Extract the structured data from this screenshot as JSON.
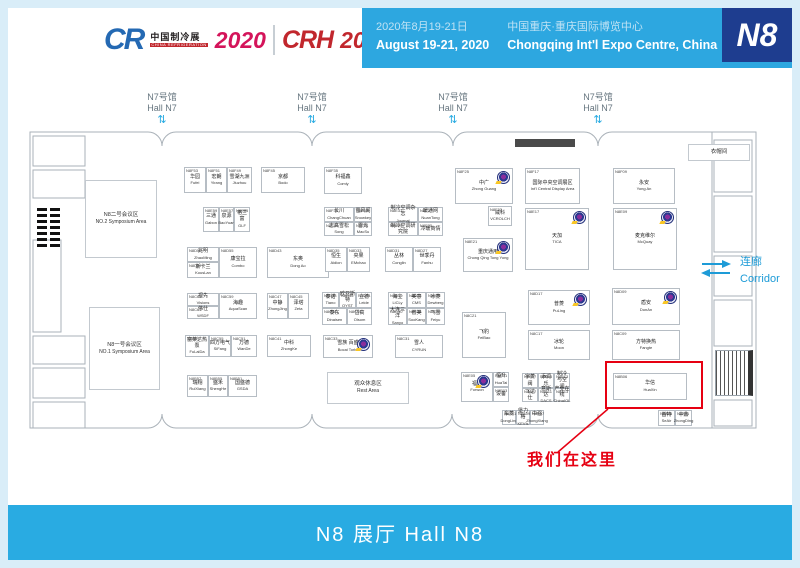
{
  "header": {
    "logo": {
      "cr": "CR",
      "cr_cn": "中国制冷展",
      "cr_en": "CHINA REFRIGERATION",
      "year1": "2020",
      "crh": "CRH",
      "year2": "2020",
      "tag_cn": "制冷·空调·暖通",
      "tag_en": "HVAC&R"
    },
    "dates_cn": "2020年8月19-21日",
    "dates_en": "August 19-21, 2020",
    "venue_cn": "中国重庆·重庆国际博览中心",
    "venue_en": "Chongqing Int'l Expo Centre, China",
    "badge": "N8"
  },
  "n7": {
    "cn": "N7号馆",
    "en": "Hall N7"
  },
  "icons": {
    "updown": "⇅"
  },
  "corridor": {
    "cn": "连廊",
    "en": "Corridor"
  },
  "marker_text": "我们在这里",
  "footer": {
    "label": "N8 展厅  Hall N8"
  },
  "colors": {
    "accent_blue": "#29abe2",
    "deep_blue": "#1e3d8f",
    "highlight_red": "#e60012"
  },
  "areas": {
    "sym2": {
      "cn": "N8二号会议区",
      "en": "NO.2 Symposium Area"
    },
    "sym1": {
      "cn": "N8一号会议区",
      "en": "NO.1 Symposium Area"
    },
    "rest": {
      "cn": "观众休息区",
      "en": "Rest Area"
    },
    "cloak": {
      "cn": "衣帽间",
      "en": "Cloakroom"
    }
  },
  "highlight": {
    "booth_id": "N8B06"
  },
  "booths": [
    {
      "id": "N8F53",
      "cn": "华园",
      "en": "Fufei",
      "x": 184,
      "y": 167,
      "w": 22,
      "h": 26
    },
    {
      "id": "N8F51",
      "cn": "宏朗",
      "en": "Yirang",
      "x": 206,
      "y": 167,
      "w": 21,
      "h": 26
    },
    {
      "id": "N8F49",
      "cn": "雪湖九洲",
      "en": "Jiuzhou",
      "x": 227,
      "y": 167,
      "w": 25,
      "h": 26
    },
    {
      "id": "N8F45",
      "cn": "京都",
      "en": "Bodo",
      "x": 261,
      "y": 167,
      "w": 44,
      "h": 26
    },
    {
      "id": "N8F35",
      "cn": "科福鑫",
      "en": "Comly",
      "x": 324,
      "y": 167,
      "w": 38,
      "h": 27
    },
    {
      "id": "N8F25",
      "cn": "中广",
      "en": "Zhong Guang",
      "x": 455,
      "y": 168,
      "w": 58,
      "h": 36,
      "logo": true
    },
    {
      "id": "N8F17",
      "cn": "国际中央空调展区",
      "en": "Int'l Central Display Area",
      "x": 525,
      "y": 168,
      "w": 55,
      "h": 36
    },
    {
      "id": "N8F09",
      "cn": "永安",
      "en": "Yong An",
      "x": 613,
      "y": 168,
      "w": 62,
      "h": 36
    },
    {
      "id": "N8E59",
      "cn": "三通",
      "en": "Gabon",
      "x": 203,
      "y": 207,
      "w": 16,
      "h": 25
    },
    {
      "id": "N8E57",
      "cn": "泉源",
      "en": "BaoYuan",
      "x": 219,
      "y": 207,
      "w": 15,
      "h": 25
    },
    {
      "id": "N8E55",
      "cn": "格兰富",
      "en": "GLF",
      "x": 234,
      "y": 207,
      "w": 16,
      "h": 25
    },
    {
      "id": "N8F30",
      "cn": "长川",
      "en": "ChangChuan",
      "x": 324,
      "y": 207,
      "w": 30,
      "h": 15
    },
    {
      "id": "N8F32",
      "cn": "雪风阁",
      "en": "Snowkey",
      "x": 354,
      "y": 207,
      "w": 18,
      "h": 15
    },
    {
      "id": "N8E30",
      "cn": "志高雪松",
      "en": "Song",
      "x": 324,
      "y": 222,
      "w": 30,
      "h": 14
    },
    {
      "id": "N8E34",
      "cn": "雪光",
      "en": "MacSu",
      "x": 354,
      "y": 222,
      "w": 18,
      "h": 14
    },
    {
      "id": "N8E31",
      "cn": "制冷空调杂志",
      "en": "Journal",
      "x": 388,
      "y": 207,
      "w": 30,
      "h": 15
    },
    {
      "id": "N8E27",
      "cn": "暖通网",
      "en": "NuanTong",
      "x": 418,
      "y": 207,
      "w": 25,
      "h": 15
    },
    {
      "id": "N8E29",
      "cn": "制冷空调研究院",
      "en": "",
      "x": 388,
      "y": 222,
      "w": 30,
      "h": 14
    },
    {
      "id": "N8E25",
      "cn": "冷暖商情",
      "en": "",
      "x": 418,
      "y": 222,
      "w": 25,
      "h": 14
    },
    {
      "id": "N8F23",
      "cn": "威科",
      "en": "VCROLCH",
      "x": 488,
      "y": 206,
      "w": 24,
      "h": 20
    },
    {
      "id": "N8E17",
      "cn": "天加",
      "en": "TICA",
      "x": 525,
      "y": 208,
      "w": 64,
      "h": 62,
      "logo": true
    },
    {
      "id": "N8E09",
      "cn": "麦克维尔",
      "en": "McQuay",
      "x": 613,
      "y": 208,
      "w": 64,
      "h": 62,
      "logo": true
    },
    {
      "id": "N8E21",
      "cn": "重庆通用",
      "en": "Chong Qing Tong Yong",
      "x": 463,
      "y": 238,
      "w": 50,
      "h": 34,
      "logo": true
    },
    {
      "id": "N8D59",
      "cn": "兆明",
      "en": "ZhaoMing",
      "x": 187,
      "y": 247,
      "w": 32,
      "h": 15
    },
    {
      "id": "N8D57",
      "cn": "斯卡兰",
      "en": "KousLan",
      "x": 187,
      "y": 262,
      "w": 32,
      "h": 16
    },
    {
      "id": "N8D55",
      "cn": "康宝拉",
      "en": "Combo",
      "x": 219,
      "y": 247,
      "w": 38,
      "h": 31
    },
    {
      "id": "N8D43",
      "cn": "东奥",
      "en": "Dong Ao",
      "x": 267,
      "y": 247,
      "w": 62,
      "h": 31
    },
    {
      "id": "N8D35",
      "cn": "恒生",
      "en": "Aidion",
      "x": 325,
      "y": 247,
      "w": 22,
      "h": 25
    },
    {
      "id": "N8D33",
      "cn": "央果",
      "en": "EMchao",
      "x": 347,
      "y": 247,
      "w": 23,
      "h": 25
    },
    {
      "id": "N8D31",
      "cn": "丛林",
      "en": "Conglin",
      "x": 385,
      "y": 247,
      "w": 28,
      "h": 25
    },
    {
      "id": "N8D27",
      "cn": "世季丹",
      "en": "Fanhu",
      "x": 413,
      "y": 247,
      "w": 28,
      "h": 25
    },
    {
      "id": "N8D17",
      "cn": "普菱",
      "en": "PuLing",
      "x": 528,
      "y": 290,
      "w": 62,
      "h": 35,
      "logo": true
    },
    {
      "id": "N8D09",
      "cn": "盾安",
      "en": "DunAn",
      "x": 612,
      "y": 288,
      "w": 68,
      "h": 37,
      "logo": true
    },
    {
      "id": "N8C63",
      "cn": "视先",
      "en": "Visions",
      "x": 187,
      "y": 293,
      "w": 32,
      "h": 13
    },
    {
      "id": "N8C61",
      "cn": "伟仕",
      "en": "WSDF",
      "x": 187,
      "y": 306,
      "w": 32,
      "h": 13
    },
    {
      "id": "N8C59",
      "cn": "海趣",
      "en": "AquaScan",
      "x": 219,
      "y": 293,
      "w": 38,
      "h": 26
    },
    {
      "id": "N8C47",
      "cn": "中静",
      "en": "ZhongJing",
      "x": 267,
      "y": 293,
      "w": 21,
      "h": 26
    },
    {
      "id": "N8C45",
      "cn": "泽塔",
      "en": "Zeta",
      "x": 288,
      "y": 293,
      "w": 21,
      "h": 26
    },
    {
      "id": "N8D38",
      "cn": "泰诺",
      "en": "Tiano",
      "x": 322,
      "y": 292,
      "w": 17,
      "h": 16
    },
    {
      "id": "N8D36",
      "cn": "欧亚斯特",
      "en": "OYST",
      "x": 339,
      "y": 292,
      "w": 17,
      "h": 16
    },
    {
      "id": "N8D34",
      "cn": "立德",
      "en": "Leide",
      "x": 356,
      "y": 292,
      "w": 16,
      "h": 16
    },
    {
      "id": "N8C38",
      "cn": "泰东",
      "en": "Dinaisen",
      "x": 322,
      "y": 308,
      "w": 25,
      "h": 17
    },
    {
      "id": "N8C34",
      "cn": "岱高",
      "en": "Olsom",
      "x": 347,
      "y": 308,
      "w": 25,
      "h": 17
    },
    {
      "id": "N8D30",
      "cn": "海立",
      "en": "LiCLy",
      "x": 388,
      "y": 292,
      "w": 19,
      "h": 16
    },
    {
      "id": "N8D28",
      "cn": "美意",
      "en": "CMS",
      "x": 407,
      "y": 292,
      "w": 19,
      "h": 16
    },
    {
      "id": "N8D26",
      "cn": "冰菱",
      "en": "Dewberg",
      "x": 426,
      "y": 292,
      "w": 19,
      "h": 16
    },
    {
      "id": "N8C30",
      "cn": "大连三洋",
      "en": "Sanyo",
      "x": 388,
      "y": 308,
      "w": 19,
      "h": 17
    },
    {
      "id": "N8C28",
      "cn": "普美",
      "en": "SooKang",
      "x": 407,
      "y": 308,
      "w": 19,
      "h": 17
    },
    {
      "id": "N8C26",
      "cn": "飞雪",
      "en": "Feiyu",
      "x": 426,
      "y": 308,
      "w": 19,
      "h": 17
    },
    {
      "id": "N8C21",
      "cn": "飞豹",
      "en": "FeiBao",
      "x": 462,
      "y": 312,
      "w": 44,
      "h": 46
    },
    {
      "id": "N8C57",
      "cn": "富莱达热泵",
      "en": "FuLaiDa",
      "x": 185,
      "y": 335,
      "w": 24,
      "h": 22
    },
    {
      "id": "N8C55",
      "cn": "四方电气",
      "en": "SiFang",
      "x": 209,
      "y": 335,
      "w": 22,
      "h": 22
    },
    {
      "id": "N8C51",
      "cn": "万德",
      "en": "WanDe",
      "x": 231,
      "y": 335,
      "w": 26,
      "h": 22
    },
    {
      "id": "N8C41",
      "cn": "中科",
      "en": "ZhongKe",
      "x": 267,
      "y": 335,
      "w": 44,
      "h": 22
    },
    {
      "id": "N8C33",
      "cn": "雪族 百盛",
      "en": "Bocai Torlei",
      "x": 323,
      "y": 335,
      "w": 50,
      "h": 23,
      "logo": true
    },
    {
      "id": "N8C31",
      "cn": "雪人",
      "en": "CYRUN",
      "x": 395,
      "y": 335,
      "w": 48,
      "h": 23
    },
    {
      "id": "N8C17",
      "cn": "冰轮",
      "en": "Moon",
      "x": 528,
      "y": 330,
      "w": 62,
      "h": 30
    },
    {
      "id": "N8C09",
      "cn": "方特换热",
      "en": "Fangte",
      "x": 612,
      "y": 330,
      "w": 68,
      "h": 30
    },
    {
      "id": "N8B57",
      "cn": "瑞翔",
      "en": "RuiXiang",
      "x": 187,
      "y": 375,
      "w": 21,
      "h": 22
    },
    {
      "id": "N8B55",
      "cn": "盛禾",
      "en": "ShengHe",
      "x": 208,
      "y": 375,
      "w": 20,
      "h": 22
    },
    {
      "id": "N8B51",
      "cn": "国盛德",
      "en": "GSDA",
      "x": 228,
      "y": 375,
      "w": 29,
      "h": 22
    },
    {
      "id": "N8E05",
      "cn": "福威",
      "en": "Forwon",
      "x": 461,
      "y": 372,
      "w": 32,
      "h": 30,
      "logo": true
    },
    {
      "id": "N8E01",
      "cn": "恒升",
      "en": "HuaTai",
      "x": 493,
      "y": 372,
      "w": 16,
      "h": 15
    },
    {
      "id": "N8E03",
      "cn": "设备",
      "en": "",
      "x": 493,
      "y": 387,
      "w": 16,
      "h": 15
    },
    {
      "id": "N8B17",
      "cn": "宇菱阀",
      "en": "",
      "x": 522,
      "y": 373,
      "w": 16,
      "h": 15
    },
    {
      "id": "N8B15",
      "cn": "添润乐",
      "en": "",
      "x": 538,
      "y": 373,
      "w": 16,
      "h": 15
    },
    {
      "id": "N8B13",
      "cn": "制冷与空调",
      "en": "",
      "x": 554,
      "y": 373,
      "w": 16,
      "h": 15
    },
    {
      "id": "N8A17",
      "cn": "飞达仕",
      "en": "",
      "x": 522,
      "y": 388,
      "w": 16,
      "h": 14
    },
    {
      "id": "N8B11",
      "cn": "意斯达",
      "en": "DACS",
      "x": 538,
      "y": 388,
      "w": 16,
      "h": 14
    },
    {
      "id": "N8A13",
      "cn": "产业在线",
      "en": "ChinaIOL",
      "x": 554,
      "y": 388,
      "w": 16,
      "h": 14
    },
    {
      "id": "N8B06",
      "cn": "华信",
      "en": "HuaXin",
      "x": 613,
      "y": 373,
      "w": 74,
      "h": 27
    },
    {
      "id": "N8A41",
      "cn": "东菱",
      "en": "DongLing",
      "x": 502,
      "y": 410,
      "w": 14,
      "h": 15
    },
    {
      "id": "N8A09",
      "cn": "堡力格",
      "en": "KEVIs",
      "x": 516,
      "y": 410,
      "w": 14,
      "h": 15
    },
    {
      "id": "N8A07",
      "cn": "中强",
      "en": "ZhongXiang",
      "x": 530,
      "y": 410,
      "w": 14,
      "h": 15
    },
    {
      "id": "N8A05",
      "cn": "首特",
      "en": "SeAir",
      "x": 658,
      "y": 410,
      "w": 17,
      "h": 16
    },
    {
      "id": "N8A01",
      "cn": "中鼎",
      "en": "ZhongDing",
      "x": 675,
      "y": 410,
      "w": 17,
      "h": 16
    }
  ]
}
